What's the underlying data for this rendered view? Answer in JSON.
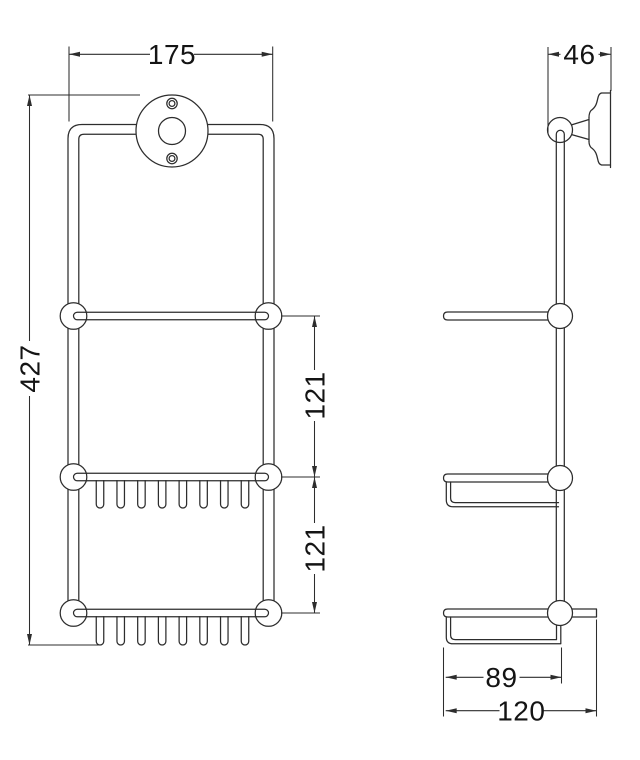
{
  "drawing": {
    "background_color": "#ffffff",
    "line_color": "#2d2d2d",
    "text_color": "#141414",
    "dimensions": {
      "overall_width": "175",
      "bracket_depth": "46",
      "overall_height": "427",
      "upper_shelf_spacing": "121",
      "lower_shelf_spacing": "121",
      "basket_depth": "89",
      "overall_depth": "120"
    }
  }
}
